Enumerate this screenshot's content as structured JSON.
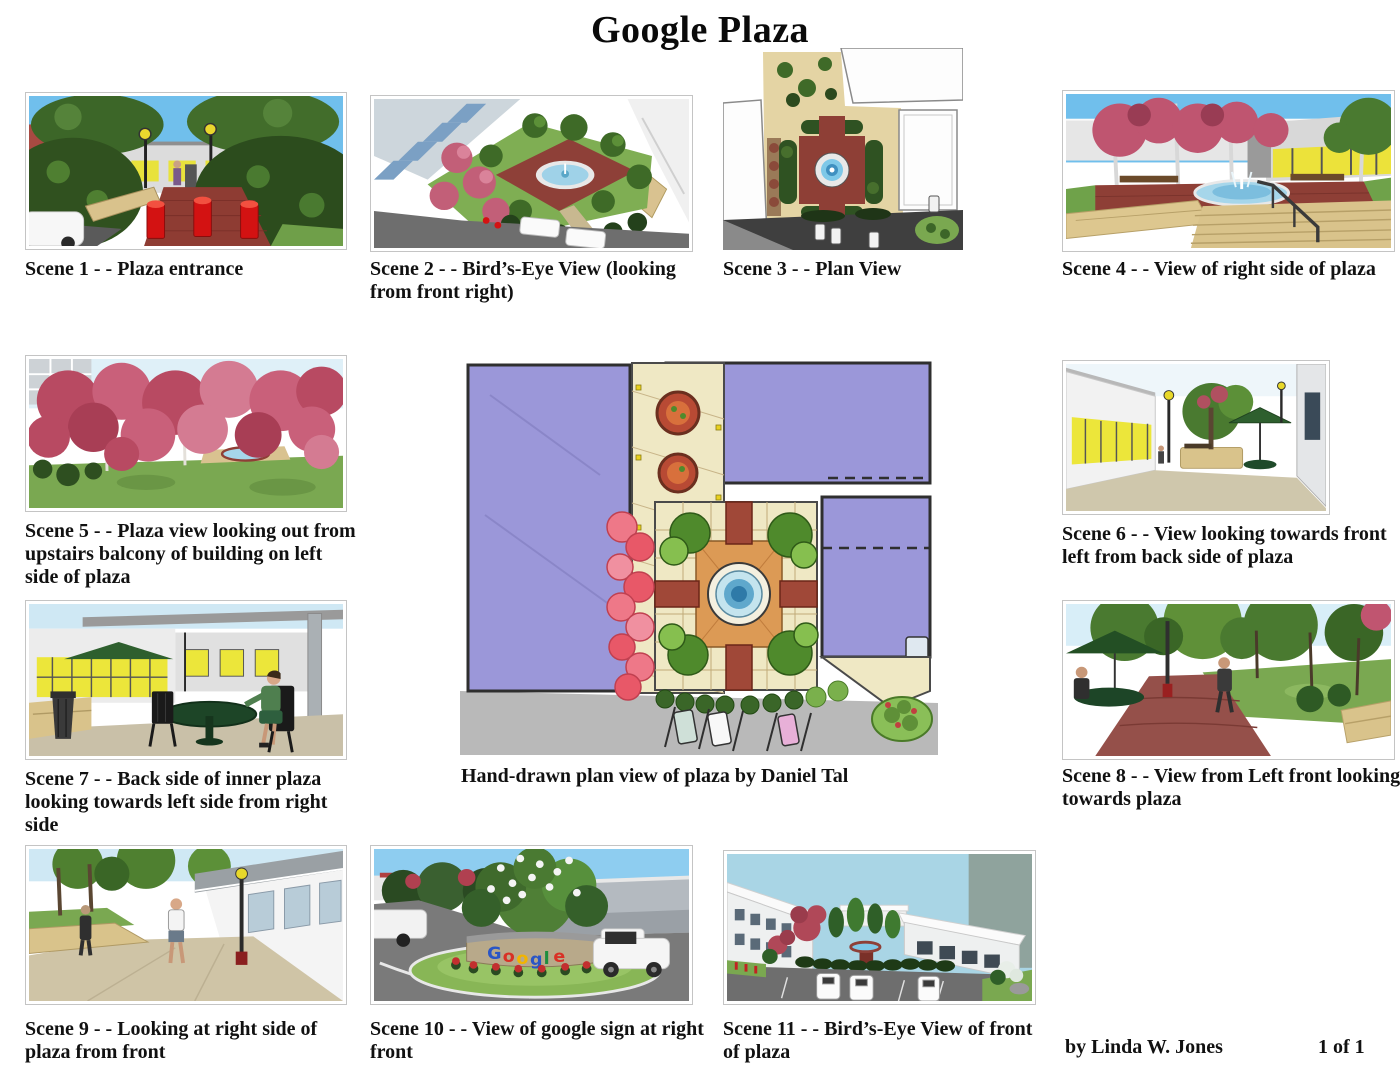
{
  "title": "Google Plaza",
  "scenes": [
    {
      "caption": "Scene 1 - -  Plaza entrance"
    },
    {
      "caption": "Scene 2 - - Bird’s-Eye View (looking from front right)"
    },
    {
      "caption": "Scene 3 - - Plan View"
    },
    {
      "caption": "Scene 4 - - View of right side of plaza"
    },
    {
      "caption": "Scene 5 - - Plaza view looking out from upstairs balcony of building on left side of plaza"
    },
    {
      "caption": "Scene 6 - - View looking towards front left from back side of plaza"
    },
    {
      "caption": "Scene 7 - - Back side of inner plaza looking towards left side from right side"
    },
    {
      "caption": "Scene 8 - - View from Left front looking towards plaza"
    },
    {
      "caption": "Scene 9 - - Looking at right side of plaza from front"
    },
    {
      "caption": "Scene 10 - - View of google sign at right front"
    },
    {
      "caption": "Scene 11 - - Bird’s-Eye View of front of plaza"
    }
  ],
  "center_caption": "Hand-drawn plan view of plaza by Daniel Tal",
  "footer": {
    "author": "by Linda W. Jones",
    "page": "1 of 1"
  },
  "google_sign": {
    "letters": [
      "G",
      "o",
      "o",
      "g",
      "l",
      "e"
    ],
    "colors": [
      "#2a56c6",
      "#d93025",
      "#f2b400",
      "#2a56c6",
      "#1e8e3e",
      "#d93025"
    ]
  }
}
